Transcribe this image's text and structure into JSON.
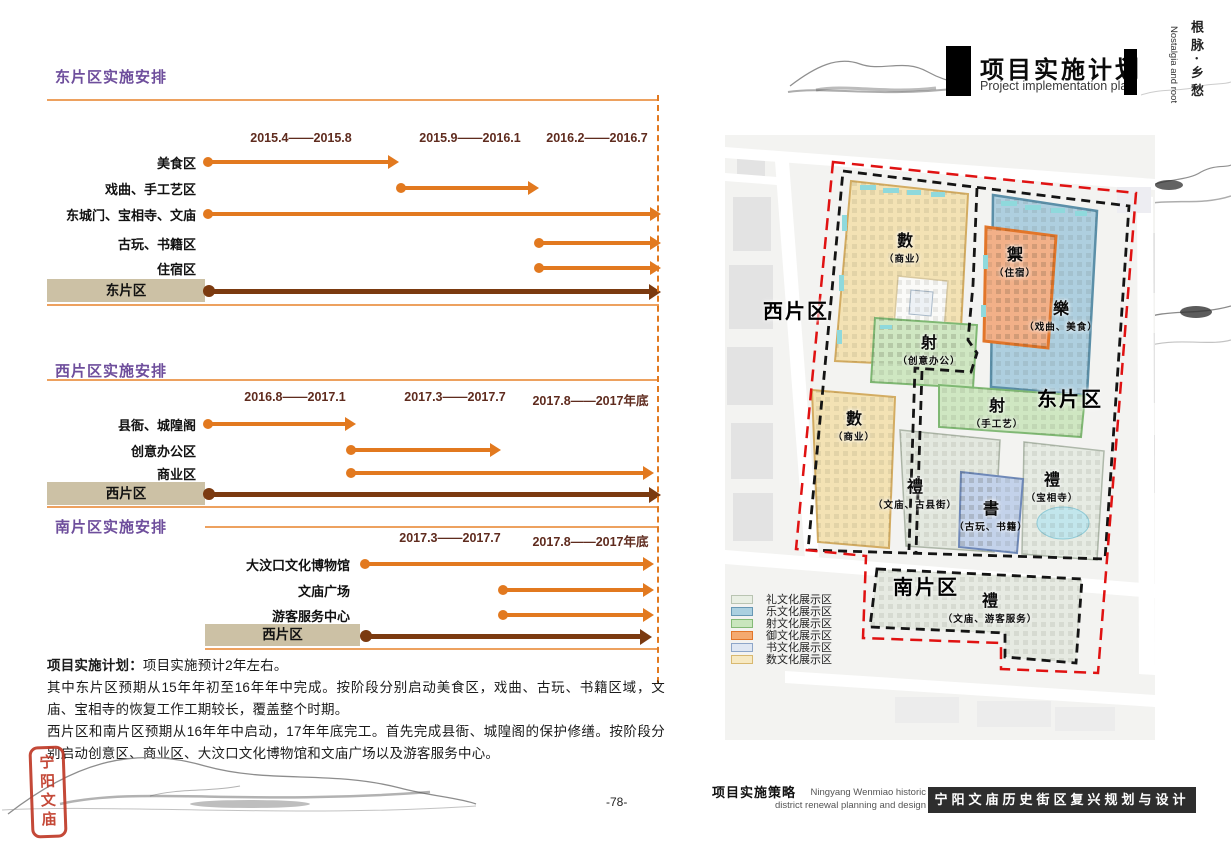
{
  "page": {
    "title_cn": "项目实施计划",
    "title_en": "Project implementation plan",
    "side_cn": "根脉·乡愁",
    "side_en": "Nostalgia and root",
    "seal": "宁阳文庙"
  },
  "colors": {
    "accent_orange": "#E2791F",
    "dark_brown": "#7B3A10",
    "section_purple": "#6E4E9C",
    "summary_tan": "#CCC1A5",
    "date_text": "#5F2B1E",
    "boundary_red": "#E01212",
    "boundary_black": "#141414"
  },
  "sections": [
    {
      "title": "东片区实施安排",
      "periods": [
        "2015.4——2015.8",
        "2015.9——2016.1",
        "2016.2——2016.7"
      ],
      "rows": [
        {
          "label": "美食区",
          "span": [
            0,
            0
          ]
        },
        {
          "label": "戏曲、手工艺区",
          "span": [
            1,
            1
          ]
        },
        {
          "label": "东城门、宝相寺、文庙",
          "span": [
            0,
            2
          ]
        },
        {
          "label": "古玩、书籍区",
          "span": [
            2,
            2
          ]
        },
        {
          "label": "住宿区",
          "span": [
            2,
            2
          ]
        }
      ],
      "summary": {
        "label": "东片区",
        "span": [
          0,
          2
        ]
      }
    },
    {
      "title": "西片区实施安排",
      "periods": [
        "2016.8——2017.1",
        "2017.3——2017.7",
        "2017.8——2017年底"
      ],
      "rows": [
        {
          "label": "县衙、城隍阁",
          "span": [
            0,
            0
          ]
        },
        {
          "label": "创意办公区",
          "span": [
            1,
            1
          ]
        },
        {
          "label": "商业区",
          "span": [
            1,
            2
          ]
        }
      ],
      "summary": {
        "label": "西片区",
        "span": [
          0,
          2
        ]
      }
    },
    {
      "title": "南片区实施安排",
      "periods": [
        "2017.3——2017.7",
        "2017.8——2017年底"
      ],
      "rows": [
        {
          "label": "大汶口文化博物馆",
          "span": [
            0,
            1
          ]
        },
        {
          "label": "文庙广场",
          "span": [
            1,
            1
          ]
        },
        {
          "label": "游客服务中心",
          "span": [
            1,
            1
          ]
        }
      ],
      "summary": {
        "label": "西片区",
        "span": [
          0,
          1
        ]
      }
    }
  ],
  "notes": {
    "lead": "项目实施计划：",
    "line1": "项目实施预计2年左右。",
    "para1": "其中东片区预期从15年年初至16年年中完成。按阶段分别启动美食区，戏曲、古玩、书籍区域，文庙、宝相寺的恢复工作工期较长，覆盖整个时期。",
    "para2": "西片区和南片区预期从16年年中启动，17年年底完工。首先完成县衙、城隍阁的保护修缮。按阶段分别启动创意区、商业区、大汶口文化博物馆和文庙广场以及游客服务中心。"
  },
  "map": {
    "districts": [
      {
        "label": "西片区"
      },
      {
        "label": "东片区"
      },
      {
        "label": "南片区"
      }
    ],
    "zones": [
      {
        "glyph": "數",
        "sub": "（商业）",
        "color": "#F3E2B4"
      },
      {
        "glyph": "禦",
        "sub": "（住宿）",
        "color": "#F2B088"
      },
      {
        "glyph": "樂",
        "sub": "（戏曲、美食）",
        "color": "#AECFDF"
      },
      {
        "glyph": "射",
        "sub": "（创意办公）",
        "color": "#CFE7C2"
      },
      {
        "glyph": "數",
        "sub": "（商业）",
        "color": "#F3E2B4"
      },
      {
        "glyph": "射",
        "sub": "（手工艺）",
        "color": "#CFE7C2"
      },
      {
        "glyph": "禮",
        "sub": "（文庙、古县街）",
        "color": "#E3E8DF"
      },
      {
        "glyph": "書",
        "sub": "（古玩、书籍）",
        "color": "#C3D2EA"
      },
      {
        "glyph": "禮",
        "sub": "（宝相寺）",
        "color": "#E6EBE3"
      },
      {
        "glyph": "禮",
        "sub": "（文庙、游客服务）",
        "color": "#E6EAE2"
      }
    ],
    "legend": [
      {
        "label": "礼文化展示区",
        "color": "#E9EFE4"
      },
      {
        "label": "乐文化展示区",
        "color": "#ABD0E0"
      },
      {
        "label": "射文化展示区",
        "color": "#C9E6BD"
      },
      {
        "label": "御文化展示区",
        "color": "#F4AA70"
      },
      {
        "label": "书文化展示区",
        "color": "#DFE7F3"
      },
      {
        "label": "数文化展示区",
        "color": "#F7E9C2"
      }
    ]
  },
  "footer": {
    "page_number": "-78-",
    "cn": "项目实施策略",
    "en1": "Ningyang Wenmiao historic",
    "en2": "district renewal planning and design",
    "band": "宁阳文庙历史街区复兴规划与设计"
  }
}
